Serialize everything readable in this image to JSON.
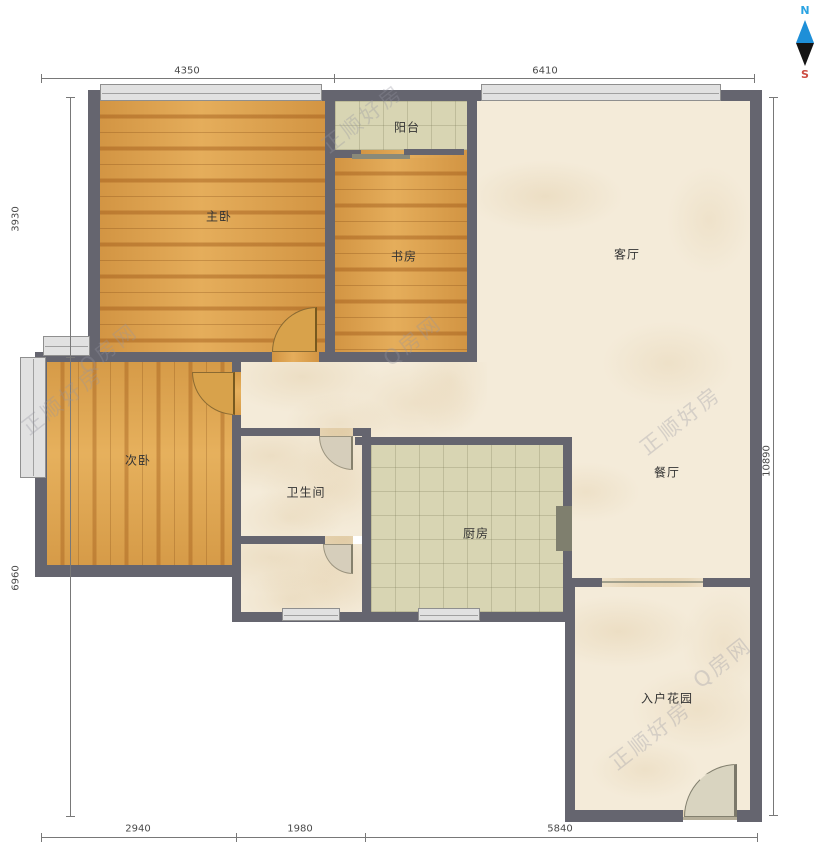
{
  "rooms": {
    "master_bedroom": {
      "label": "主卧"
    },
    "study": {
      "label": "书房"
    },
    "balcony": {
      "label": "阳台"
    },
    "living_room": {
      "label": "客厅"
    },
    "second_bedroom": {
      "label": "次卧"
    },
    "bathroom": {
      "label": "卫生间"
    },
    "kitchen": {
      "label": "厨房"
    },
    "dining_room": {
      "label": "餐厅"
    },
    "entry_garden": {
      "label": "入户花园"
    }
  },
  "dimensions_mm": {
    "top": [
      {
        "value": "4350"
      },
      {
        "value": "6410"
      }
    ],
    "left": [
      {
        "value": "3930"
      },
      {
        "value": "6960"
      }
    ],
    "right": [
      {
        "value": "10890"
      }
    ],
    "bottom": [
      {
        "value": "2940"
      },
      {
        "value": "1980"
      },
      {
        "value": "5840"
      }
    ]
  },
  "compass": {
    "north_label": "N",
    "south_label": "S",
    "north_color": "#2aa3e2",
    "south_color": "#cc4b41"
  },
  "watermark": {
    "brand": "正顺好房",
    "site": "Q房网"
  },
  "colors": {
    "wall": "#65656f",
    "wood_floor": "#e0a34d",
    "tile_floor": "#d8d5b3",
    "marble_floor": "#f4ebd9",
    "window_fill": "#e1e1e1"
  }
}
